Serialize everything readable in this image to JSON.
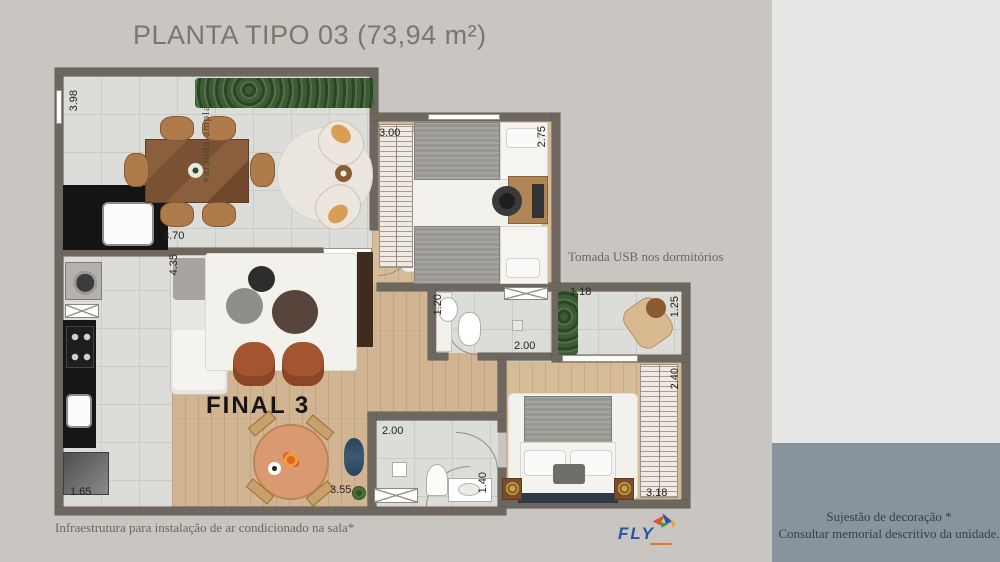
{
  "title": "PLANTA TIPO 03  (73,94 m²)",
  "plan": {
    "unit_label": "FINAL 3",
    "room_labels": {
      "varanda": "varanda ampla"
    },
    "dimensions": {
      "varanda_depth": "3.98",
      "varanda_width": "3.70",
      "dorm1_width": "3.00",
      "dorm1_depth": "2.75",
      "sala_depth": "4.35",
      "banho1_width": "1.20",
      "banho1_length": "2.00",
      "terraco_width": "1.18",
      "terraco_depth": "1.25",
      "dorm2_depth": "2.40",
      "dorm2_width": "3.18",
      "cozinha_width": "1.65",
      "sala_width": "3.55",
      "banho2_width": "2.00",
      "banho2_depth": "1.40"
    },
    "notes": {
      "usb": "Tomada USB nos dormitórios",
      "ac": "Infraestrutura para instalação de ar condicionado na sala*"
    }
  },
  "side_panel": {
    "line1": "Sujestão de decoração *",
    "line2": "Consultar memorial descritivo da unidade."
  },
  "logo": {
    "text": "FLY"
  },
  "colors": {
    "background": "#c9c5c0",
    "panel_light": "#e7e7e5",
    "panel_slate": "#88939e",
    "wall": "#6e6760",
    "floor_tile": "#dcddd9",
    "floor_wood": "#d1b592",
    "title_text": "#7d766c",
    "note_text": "#6e665d",
    "panel_text": "#33404d",
    "logo_blue": "#2753a8"
  }
}
